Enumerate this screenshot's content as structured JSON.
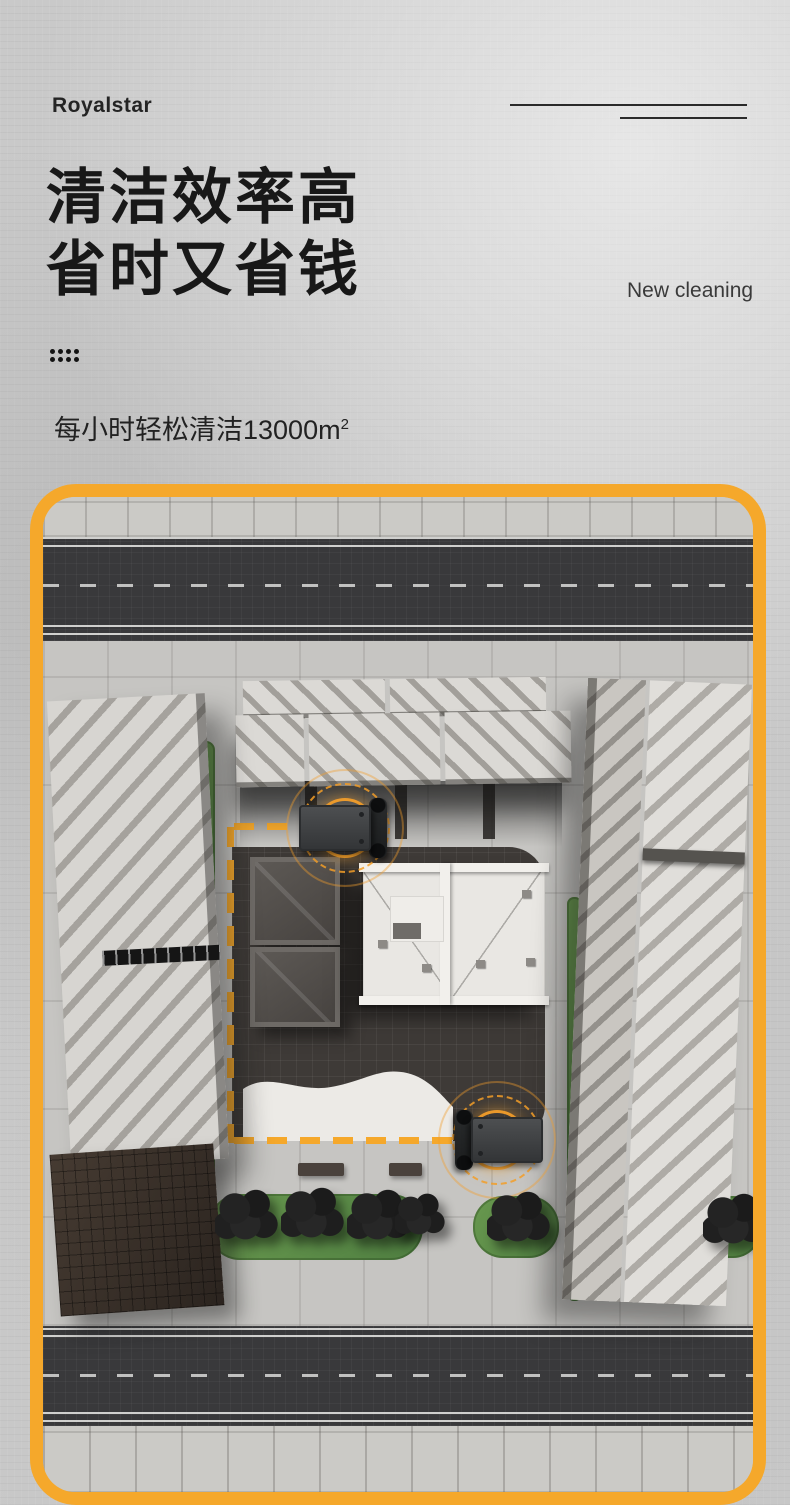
{
  "poster": {
    "brand": "Royalstar",
    "headline_line1": "清洁效率高",
    "headline_line2": "省时又省钱",
    "tagline": "New cleaning",
    "subtitle_text": "每小时轻松清洁13000m",
    "subtitle_superscript": "2"
  },
  "icons": {
    "dots_grid": "dots-grid-icon",
    "radar_signal": "radar-rings-icon"
  },
  "colors": {
    "frame_yellow": "#F5A82B",
    "radar_orange": "#F39E2A",
    "greenery_green": "#5E8E4E",
    "asphalt_dark": "#39393B",
    "courtyard_dark": "#3E3A37",
    "heading_text": "#181818",
    "concrete_background": "#C9C9C9"
  },
  "scene_objects": [
    "top-road",
    "bottom-road",
    "plaza-pavement",
    "left-striped-building",
    "brown-building",
    "top-striped-building",
    "right-striped-building",
    "dark-courtyard",
    "white-roof-building",
    "storage-containers",
    "cleaning-robot-top",
    "cleaning-robot-bottom",
    "dashed-cleaning-route",
    "green-planting-strips",
    "trees",
    "benches",
    "white-curved-path"
  ]
}
